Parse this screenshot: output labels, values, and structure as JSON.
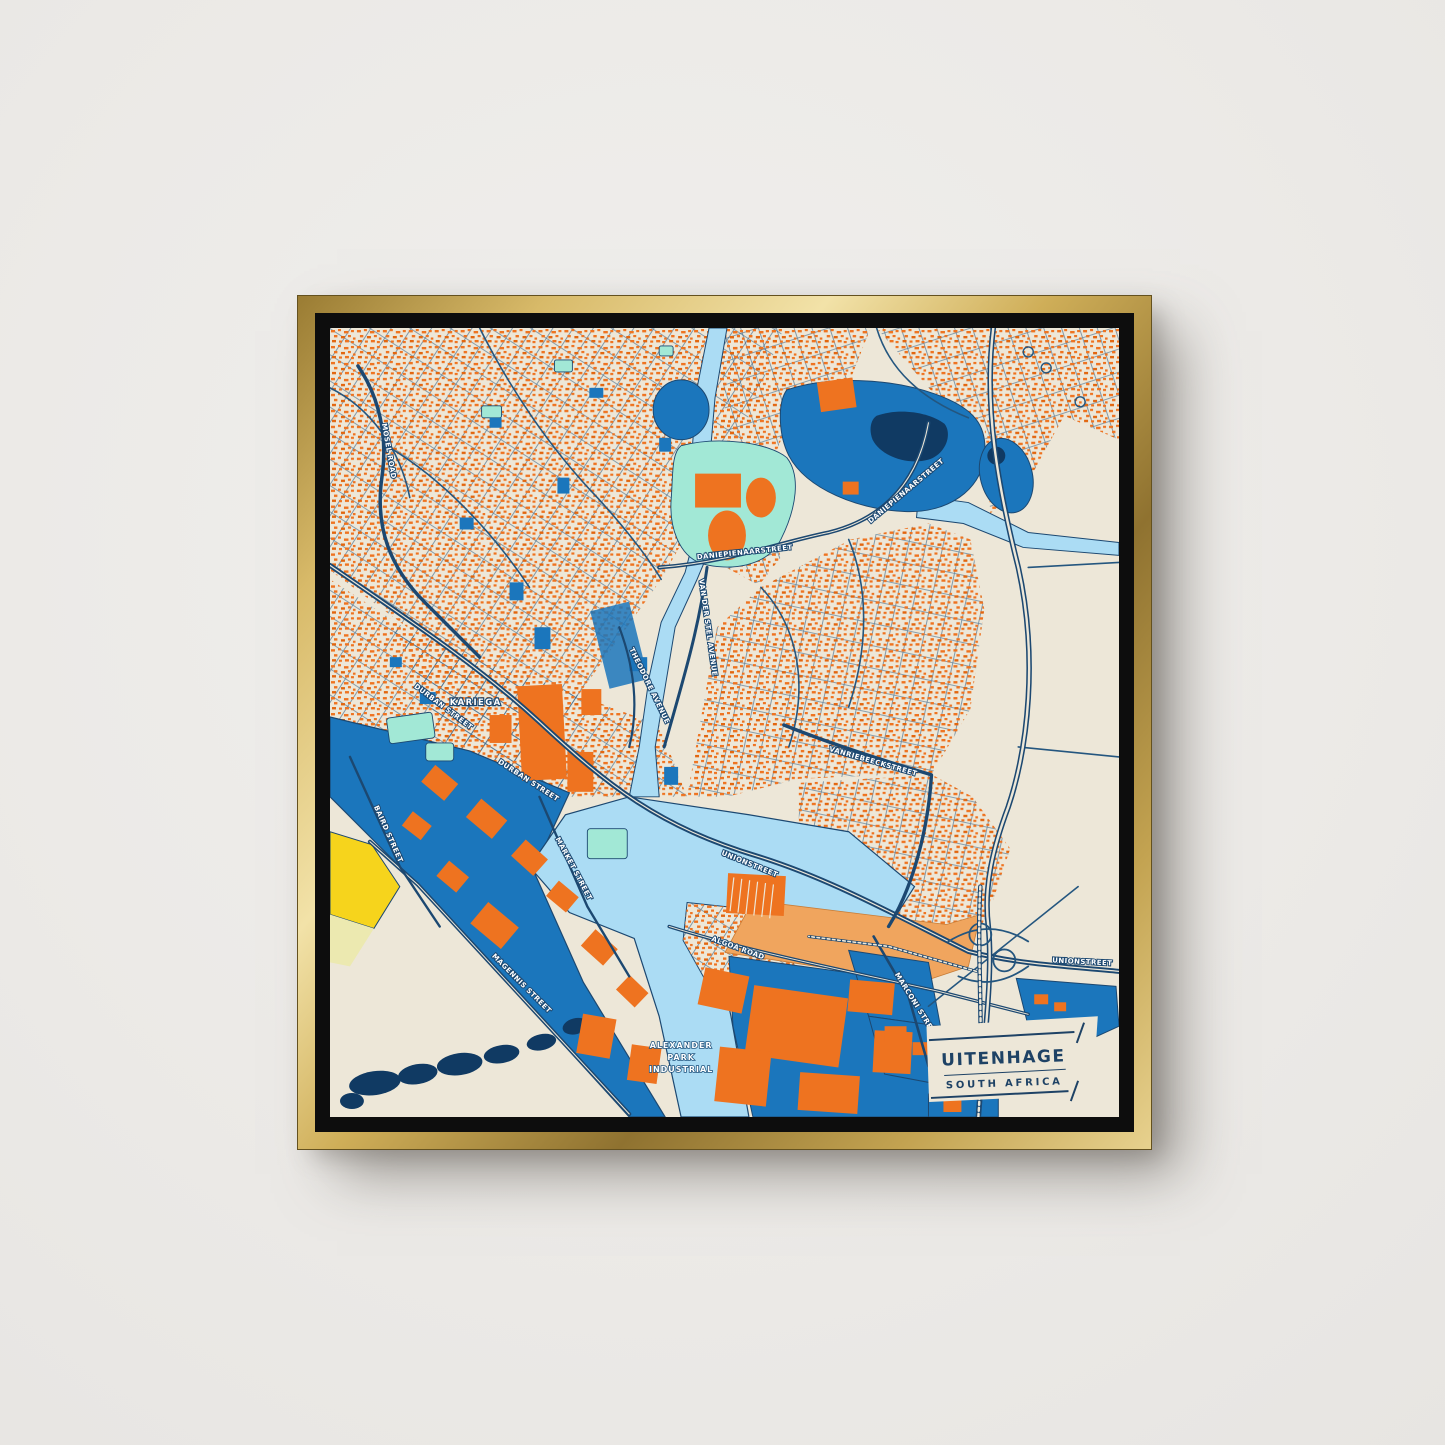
{
  "poster": {
    "title": "UITENHAGE",
    "subtitle": "SOUTH AFRICA",
    "place_labels": {
      "town": "KARIEGA"
    },
    "area_label": {
      "line1": "ALEXANDER",
      "line2": "PARK",
      "line3": "INDUSTRIAL"
    },
    "street_labels": [
      {
        "text": "MOSEL ROAD"
      },
      {
        "text": "DURBAN STREET"
      },
      {
        "text": "DURBAN STREET"
      },
      {
        "text": "BAIRD STREET"
      },
      {
        "text": "MAGENNIS STREET"
      },
      {
        "text": "MARKET STREET"
      },
      {
        "text": "THEODORE AVENUE"
      },
      {
        "text": "VAN DER STEL AVENUE"
      },
      {
        "text": "DANIEPIENAARSTREET"
      },
      {
        "text": "DANIEPIENAARSTREET"
      },
      {
        "text": "VANRIEBEECKSTREET"
      },
      {
        "text": "UNIONSTREET"
      },
      {
        "text": "UNIONSTREET"
      },
      {
        "text": "ALGOA ROAD"
      },
      {
        "text": "MARCONI STREET"
      }
    ]
  },
  "palette": {
    "wall": "#edecea",
    "frame_gold": "#c9a84c",
    "frame_gold_light": "#f2e2a8",
    "frame_gold_dark": "#8f7230",
    "float_black": "#0d0d0d",
    "canvas_cream": "#ede7d8",
    "road_navy": "#1c4871",
    "building_orange": "#ee7320",
    "zone_blue": "#1b76bc",
    "water_light": "#abdcf4",
    "park_mint": "#a2e8d6",
    "pond_navy": "#103a63",
    "accent_yellow": "#f6d41c",
    "pale_yellow": "#ece9b0",
    "rail_tan": "#f0a55e",
    "title_navy": "#1e4265",
    "label_white": "#ffffff"
  }
}
